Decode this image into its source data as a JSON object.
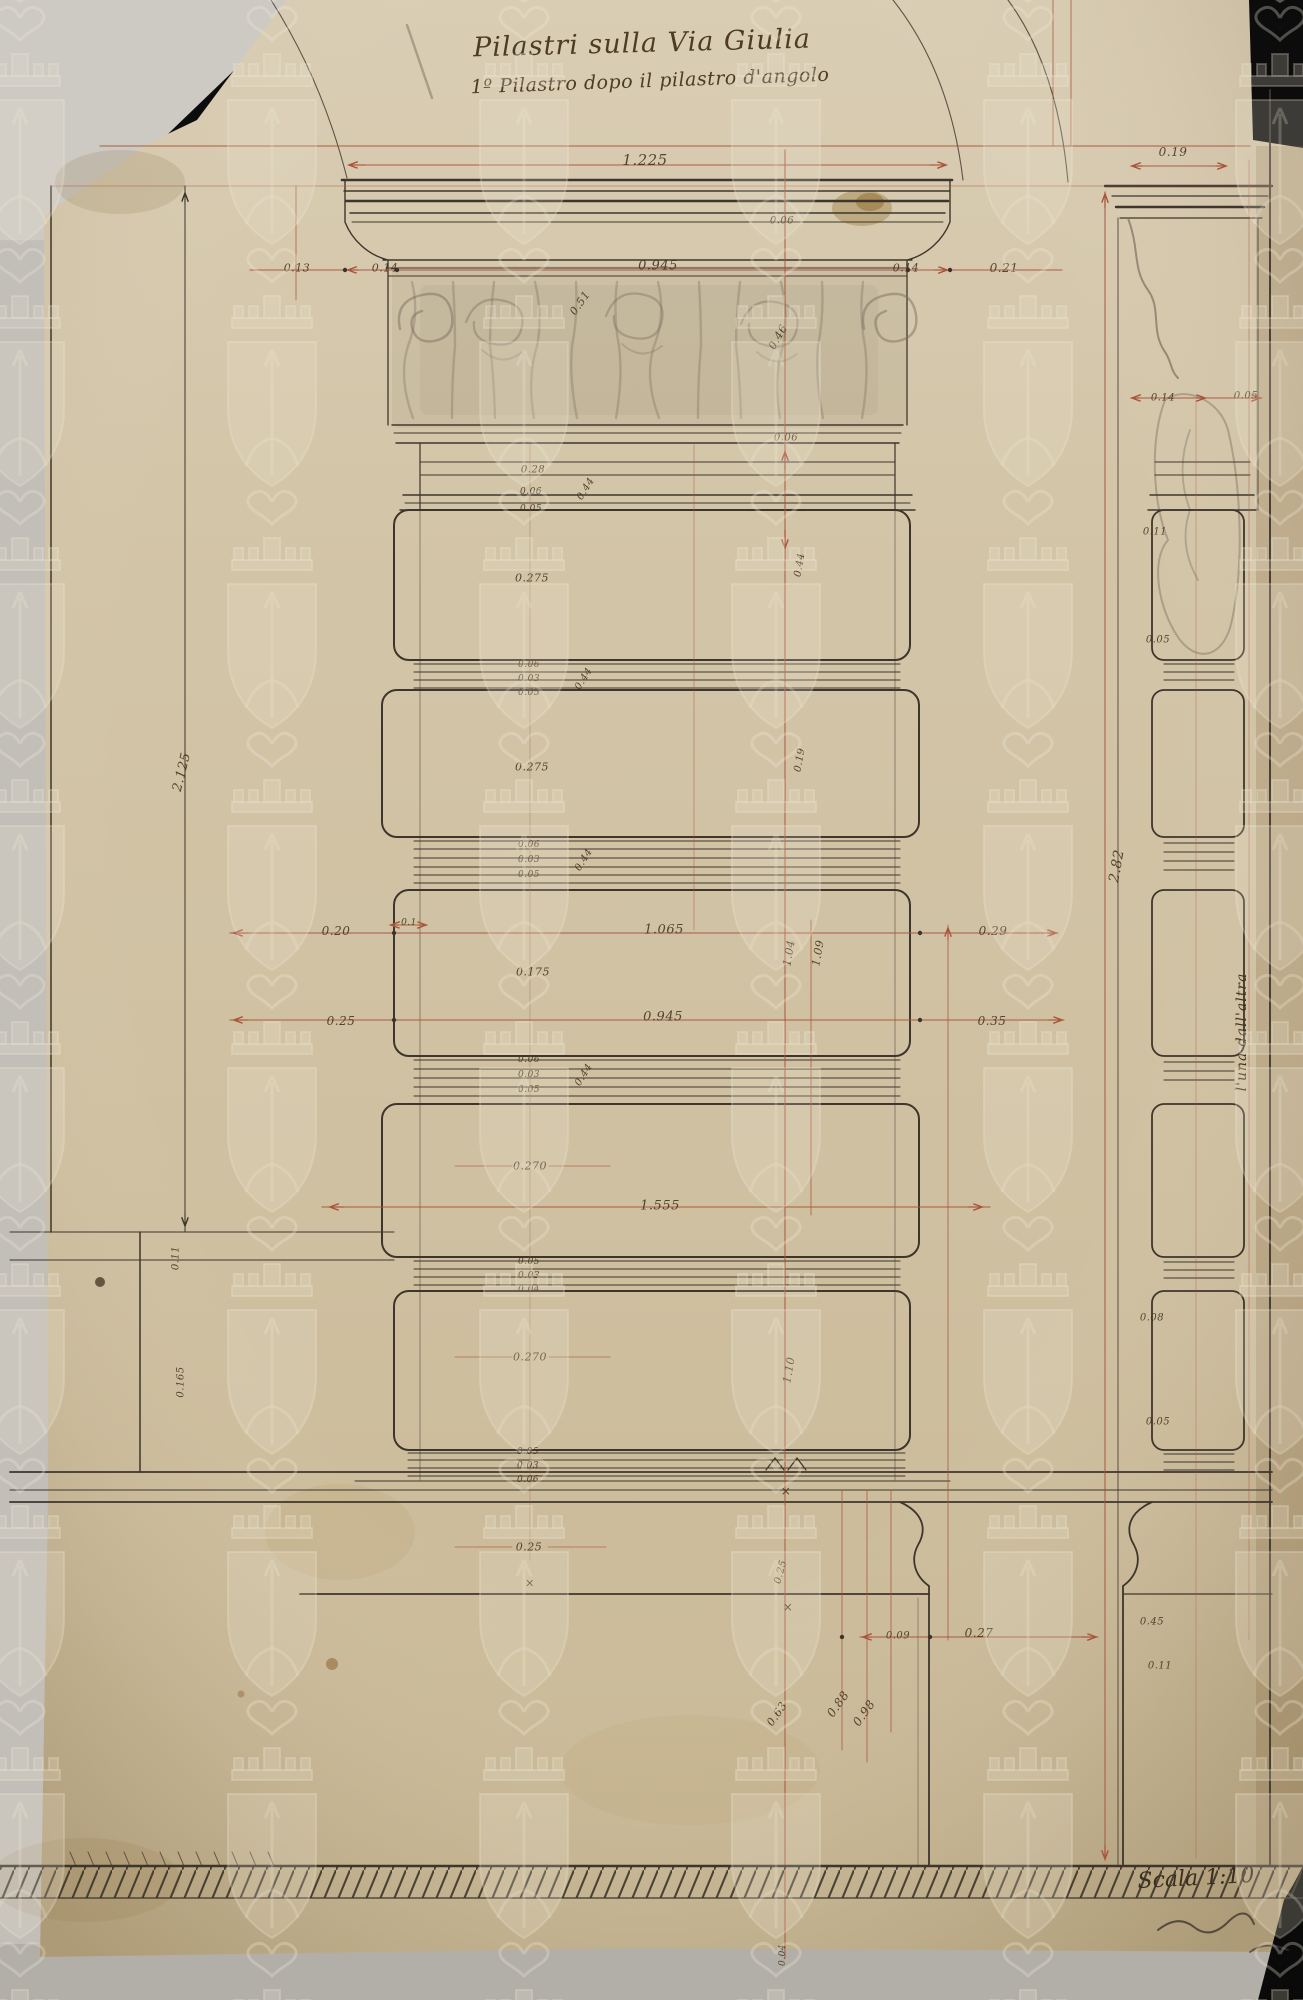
{
  "document": {
    "title_line1": "Pilastri sulla Via Giulia",
    "title_line2": "1º Pilastro dopo il pilastro d'angolo",
    "scale_label": "Scala 1:10",
    "side_note": "l'una dall'altra"
  },
  "colors": {
    "paper": "#d2c4a4",
    "ink": "#3e362d",
    "dim_red": "#a9543b",
    "pencil": "#7c6f5f",
    "watermark": "#ece4cf",
    "backdrop_dark": "#0c0c0c",
    "backdrop_light": "#c2beb8"
  },
  "watermark": {
    "icon": "mural-crown-shield-watermark-icon",
    "description": "repeating pale shield with crenellated mural crown and lily emblem"
  },
  "labels": [
    {
      "t": "1.225",
      "x": 645,
      "y": 160,
      "s": 15
    },
    {
      "t": "0.19",
      "x": 1173,
      "y": 152,
      "s": 12
    },
    {
      "t": "0.06",
      "x": 782,
      "y": 221,
      "s": 10
    },
    {
      "t": "0.13",
      "x": 297,
      "y": 268,
      "s": 11
    },
    {
      "t": "0.14",
      "x": 385,
      "y": 268,
      "s": 11
    },
    {
      "t": "0.945",
      "x": 658,
      "y": 266,
      "s": 13
    },
    {
      "t": "0.14",
      "x": 906,
      "y": 268,
      "s": 11
    },
    {
      "t": "0.21",
      "x": 1004,
      "y": 268,
      "s": 12
    },
    {
      "t": "0.51",
      "x": 580,
      "y": 303,
      "s": 11,
      "r": -55
    },
    {
      "t": "0.46",
      "x": 778,
      "y": 337,
      "s": 11,
      "r": -60
    },
    {
      "t": "0.14",
      "x": 1163,
      "y": 398,
      "s": 10
    },
    {
      "t": "0.05",
      "x": 1246,
      "y": 396,
      "s": 10
    },
    {
      "t": "0.06",
      "x": 786,
      "y": 438,
      "s": 10
    },
    {
      "t": "0.28",
      "x": 533,
      "y": 470,
      "s": 10
    },
    {
      "t": "0.06",
      "x": 531,
      "y": 492,
      "s": 9
    },
    {
      "t": "0.05",
      "x": 531,
      "y": 509,
      "s": 9
    },
    {
      "t": "0.44",
      "x": 586,
      "y": 489,
      "s": 10,
      "r": -58
    },
    {
      "t": "0.275",
      "x": 532,
      "y": 578,
      "s": 11
    },
    {
      "t": "0.44",
      "x": 800,
      "y": 565,
      "s": 10,
      "r": -80
    },
    {
      "t": "0.06",
      "x": 529,
      "y": 665,
      "s": 9
    },
    {
      "t": "0.03",
      "x": 529,
      "y": 679,
      "s": 9
    },
    {
      "t": "0.05",
      "x": 529,
      "y": 693,
      "s": 9
    },
    {
      "t": "0.44",
      "x": 584,
      "y": 679,
      "s": 10,
      "r": -58
    },
    {
      "t": "0.275",
      "x": 532,
      "y": 767,
      "s": 11
    },
    {
      "t": "0.19",
      "x": 800,
      "y": 760,
      "s": 10,
      "r": -80
    },
    {
      "t": "0.06",
      "x": 529,
      "y": 845,
      "s": 9
    },
    {
      "t": "0.03",
      "x": 529,
      "y": 860,
      "s": 9
    },
    {
      "t": "0.05",
      "x": 529,
      "y": 875,
      "s": 9
    },
    {
      "t": "0.44",
      "x": 584,
      "y": 860,
      "s": 10,
      "r": -58
    },
    {
      "t": "0.1",
      "x": 409,
      "y": 923,
      "s": 9
    },
    {
      "t": "0.20",
      "x": 336,
      "y": 931,
      "s": 12
    },
    {
      "t": "1.065",
      "x": 664,
      "y": 930,
      "s": 13
    },
    {
      "t": "0.29",
      "x": 993,
      "y": 931,
      "s": 12
    },
    {
      "t": "0.175",
      "x": 533,
      "y": 972,
      "s": 11
    },
    {
      "t": "1.04",
      "x": 789,
      "y": 953,
      "s": 11,
      "r": -80
    },
    {
      "t": "1.09",
      "x": 818,
      "y": 953,
      "s": 11,
      "r": -80
    },
    {
      "t": "0.25",
      "x": 341,
      "y": 1021,
      "s": 12
    },
    {
      "t": "0.945",
      "x": 663,
      "y": 1017,
      "s": 13
    },
    {
      "t": "0.35",
      "x": 992,
      "y": 1021,
      "s": 12
    },
    {
      "t": "0.06",
      "x": 529,
      "y": 1060,
      "s": 9
    },
    {
      "t": "0.03",
      "x": 529,
      "y": 1075,
      "s": 9
    },
    {
      "t": "0.05",
      "x": 529,
      "y": 1090,
      "s": 9
    },
    {
      "t": "0.44",
      "x": 584,
      "y": 1075,
      "s": 10,
      "r": -58
    },
    {
      "t": "0.270",
      "x": 530,
      "y": 1166,
      "s": 11
    },
    {
      "t": "1.555",
      "x": 660,
      "y": 1206,
      "s": 13
    },
    {
      "t": "0.05",
      "x": 529,
      "y": 1262,
      "s": 9
    },
    {
      "t": "0.03",
      "x": 529,
      "y": 1276,
      "s": 9
    },
    {
      "t": "0.04",
      "x": 529,
      "y": 1290,
      "s": 9
    },
    {
      "t": "0.270",
      "x": 530,
      "y": 1357,
      "s": 11
    },
    {
      "t": "1.10",
      "x": 789,
      "y": 1370,
      "s": 11,
      "r": -80
    },
    {
      "t": "0.05",
      "x": 528,
      "y": 1452,
      "s": 9
    },
    {
      "t": "0.03",
      "x": 528,
      "y": 1466,
      "s": 9
    },
    {
      "t": "0.06",
      "x": 528,
      "y": 1480,
      "s": 9
    },
    {
      "t": "0.25",
      "x": 529,
      "y": 1547,
      "s": 11
    },
    {
      "t": "0.25",
      "x": 781,
      "y": 1572,
      "s": 10,
      "r": -75
    },
    {
      "t": "0.09",
      "x": 898,
      "y": 1636,
      "s": 10
    },
    {
      "t": "0.27",
      "x": 979,
      "y": 1633,
      "s": 12
    },
    {
      "t": "0.63",
      "x": 777,
      "y": 1714,
      "s": 11,
      "r": -55
    },
    {
      "t": "0.88",
      "x": 838,
      "y": 1704,
      "s": 12,
      "r": -55
    },
    {
      "t": "0.98",
      "x": 864,
      "y": 1713,
      "s": 12,
      "r": -55
    },
    {
      "t": "2.125",
      "x": 182,
      "y": 772,
      "s": 13,
      "r": -76
    },
    {
      "t": "0.11",
      "x": 176,
      "y": 1258,
      "s": 10,
      "r": -90
    },
    {
      "t": "0.165",
      "x": 181,
      "y": 1382,
      "s": 10,
      "r": -90
    },
    {
      "t": "2.82",
      "x": 1117,
      "y": 866,
      "s": 14,
      "r": -80
    },
    {
      "t": "0.11",
      "x": 1155,
      "y": 532,
      "s": 10
    },
    {
      "t": "0.05",
      "x": 1158,
      "y": 640,
      "s": 10
    },
    {
      "t": "0.08",
      "x": 1152,
      "y": 1318,
      "s": 10
    },
    {
      "t": "0.05",
      "x": 1158,
      "y": 1422,
      "s": 10
    },
    {
      "t": "0.45",
      "x": 1152,
      "y": 1622,
      "s": 10
    },
    {
      "t": "0.11",
      "x": 1160,
      "y": 1666,
      "s": 10
    },
    {
      "t": "×",
      "x": 786,
      "y": 1491,
      "s": 12
    },
    {
      "t": "×",
      "x": 788,
      "y": 1607,
      "s": 12
    },
    {
      "t": "×",
      "x": 530,
      "y": 1583,
      "s": 11
    },
    {
      "t": "0.04",
      "x": 783,
      "y": 1955,
      "s": 9,
      "r": -90
    }
  ]
}
